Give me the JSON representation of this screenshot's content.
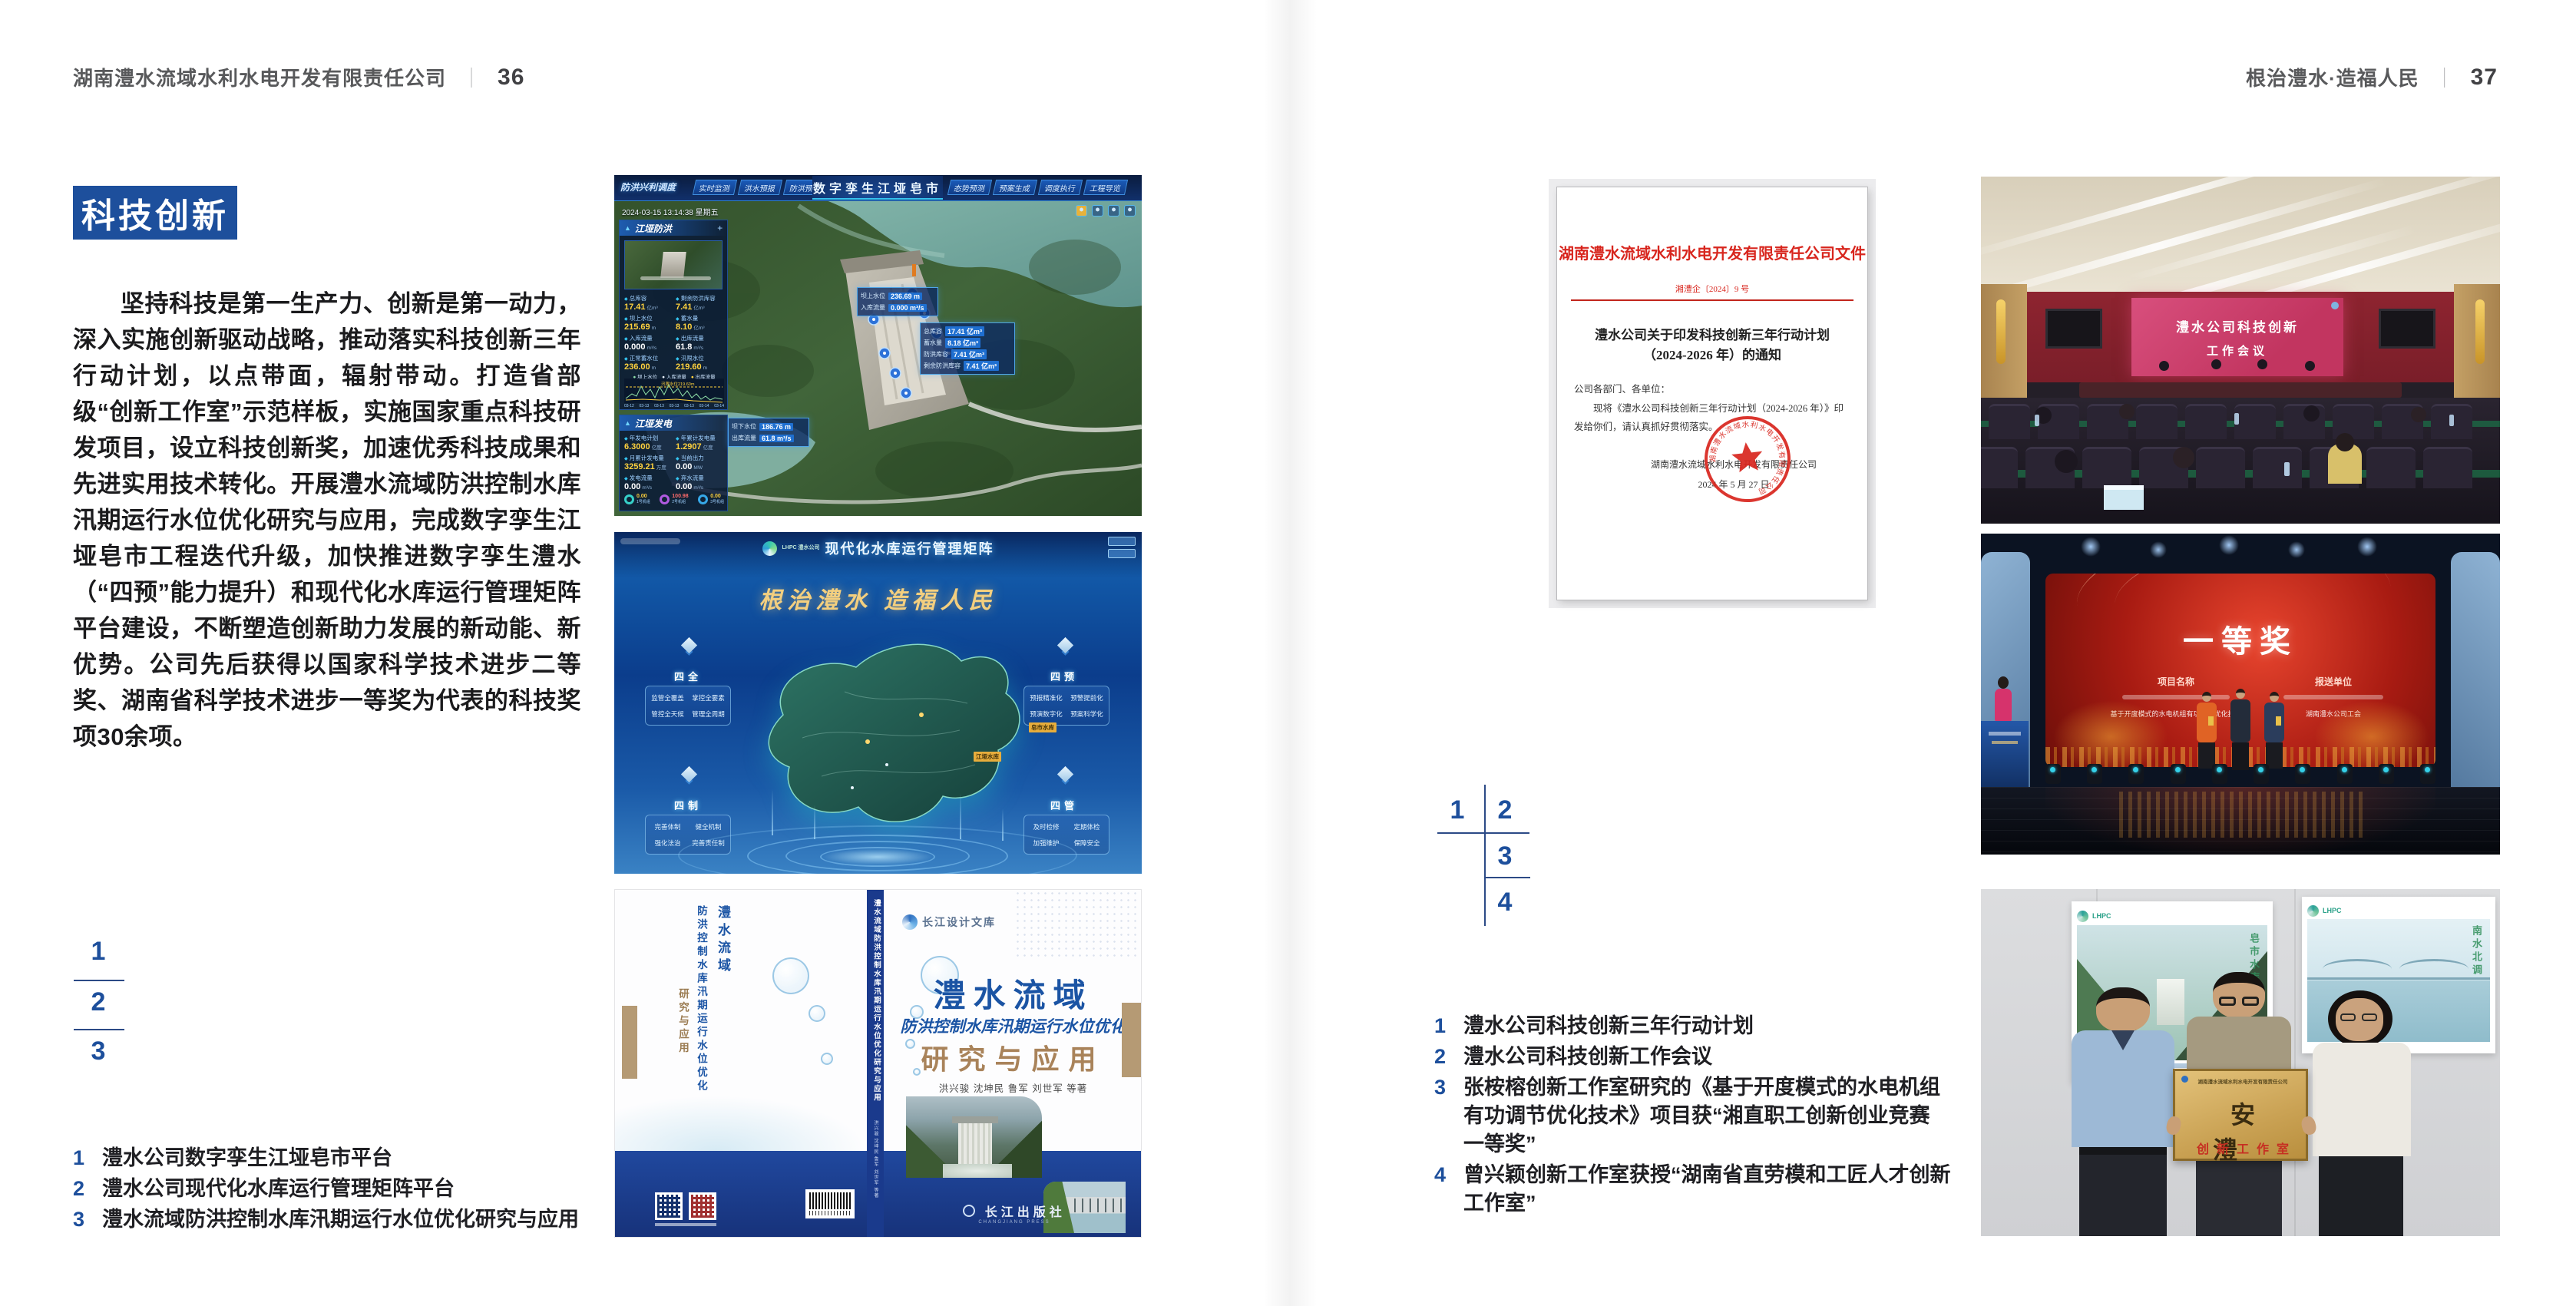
{
  "left_page": {
    "header": {
      "company": "湖南澧水流域水利水电开发有限责任公司",
      "divider": "｜",
      "page_no": "36"
    },
    "section_title": "科技创新",
    "body": "坚持科技是第一生产力、创新是第一动力，深入实施创新驱动战略，推动落实科技创新三年行动计划，以点带面，辐射带动。打造省部级“创新工作室”示范样板，实施国家重点科技研发项目，设立科技创新奖，加速优秀科技成果和先进实用技术转化。开展澧水流域防洪控制水库汛期运行水位优化研究与应用，完成数字孪生江垭皂市工程迭代升级，加快推进数字孪生澧水（“四预”能力提升）和现代化水库运行管理矩阵平台建设，不断塑造创新助力发展的新动能、新优势。公司先后获得以国家科学技术进步二等奖、湖南省科学技术进步一等奖为代表的科技奖项30余项。",
    "figure_markers": [
      "1",
      "2",
      "3"
    ],
    "captions": [
      {
        "no": "1",
        "text": "澧水公司数字孪生江垭皂市平台"
      },
      {
        "no": "2",
        "text": "澧水公司现代化水库运行管理矩阵平台"
      },
      {
        "no": "3",
        "text": "澧水流域防洪控制水库汛期运行水位优化研究与应用"
      }
    ]
  },
  "right_page": {
    "header": {
      "slogan": "根治澧水·造福人民",
      "divider": "｜",
      "page_no": "37"
    },
    "document": {
      "header": "湖南澧水流域水利水电开发有限责任公司文件",
      "doc_no": "湘澧企〔2024〕9 号",
      "title_line1": "澧水公司关于印发科技创新三年行动计划",
      "title_line2": "（2024-2026 年）的通知",
      "salutation": "公司各部门、各单位：",
      "body_line1": "现将《澧水公司科技创新三年行动计划（2024-2026 年）》印",
      "body_line2": "发给你们，请认真抓好贯彻落实。",
      "signer": "湖南澧水流域水利水电开发有限责任公司",
      "date": "2024 年 5 月 27 日"
    },
    "figure_markers": [
      "1",
      "2",
      "3",
      "4"
    ],
    "captions": [
      {
        "no": "1",
        "text": "澧水公司科技创新三年行动计划"
      },
      {
        "no": "2",
        "text": "澧水公司科技创新工作会议"
      },
      {
        "no": "3",
        "text": "张桉榕创新工作室研究的《基于开度模式的水电机组有功调节优化技术》项目获“湘直职工创新创业竞赛一等奖”"
      },
      {
        "no": "4",
        "text": "曾兴颖创新工作室获授“湖南省直劳模和工匠人才创新工作室”"
      }
    ]
  },
  "digital_twin": {
    "title": "数字孪生江垭皂市",
    "mode": "防洪兴利调度",
    "tabs_left": [
      "实时监测",
      "洪水预报",
      "防洪预警"
    ],
    "tabs_right": [
      "态势预测",
      "预案生成",
      "调度执行",
      "工程导览"
    ],
    "datetime": "2024-03-15 13:14:38 星期五",
    "panel_flood": {
      "title": "江垭防洪",
      "stats": [
        {
          "label": "总库容",
          "value": "17.41",
          "unit": "亿m³"
        },
        {
          "label": "剩余防洪库容",
          "value": "7.41",
          "unit": "亿m³"
        },
        {
          "label": "坝上水位",
          "value": "215.69",
          "unit": "m"
        },
        {
          "label": "蓄水量",
          "value": "8.10",
          "unit": "亿m³"
        },
        {
          "label": "入库流量",
          "value": "0.000",
          "unit": "m³/s"
        },
        {
          "label": "出库流量",
          "value": "61.8",
          "unit": "m³/s"
        },
        {
          "label": "正常蓄水位",
          "value": "236.00",
          "unit": "m"
        },
        {
          "label": "汛限水位",
          "value": "219.60",
          "unit": "m"
        }
      ],
      "legend": [
        "坝上水位",
        "入库流量",
        "出库流量"
      ],
      "annotation": "汛限水位219.60m",
      "x_ticks": [
        "03-12",
        "03-13",
        "03-13",
        "03-13",
        "03-13",
        "03-14",
        "03-14"
      ]
    },
    "panel_power": {
      "title": "江垭发电",
      "stats": [
        {
          "label": "年发电计划",
          "value": "6.3000",
          "unit": "亿度"
        },
        {
          "label": "年累计发电量",
          "value": "1.2907",
          "unit": "亿度"
        },
        {
          "label": "月累计发电量",
          "value": "3259.21",
          "unit": "万度"
        },
        {
          "label": "当前出力",
          "value": "0.00",
          "unit": "MW"
        },
        {
          "label": "发电流量",
          "value": "0.00",
          "unit": "m³/s"
        },
        {
          "label": "弃水流量",
          "value": "0.00",
          "unit": "m³/s"
        }
      ],
      "gauges": [
        {
          "value": "0.00",
          "label": "1号机组"
        },
        {
          "value": "100.98",
          "label": "2号机组"
        },
        {
          "value": "0.00",
          "label": "3号机组"
        }
      ]
    },
    "overlay_up": [
      {
        "label": "坝上水位",
        "value": "236.69 m"
      },
      {
        "label": "入库流量",
        "value": "0.000 m³/s"
      }
    ],
    "overlay_cap": [
      {
        "label": "总库容",
        "value": "17.41 亿m³"
      },
      {
        "label": "蓄水量",
        "value": "8.18 亿m³"
      },
      {
        "label": "防洪库容",
        "value": "7.41 亿m³"
      },
      {
        "label": "剩余防洪库容",
        "value": "7.41 亿m³"
      }
    ],
    "overlay_down": [
      {
        "label": "坝下水位",
        "value": "186.76 m"
      },
      {
        "label": "出库流量",
        "value": "61.8 m³/s"
      }
    ]
  },
  "matrix_platform": {
    "brand": "LHPC 澧水公司",
    "title": "现代化水库运行管理矩阵",
    "slogan": "根治澧水 造福人民",
    "groups": [
      {
        "name": "四全",
        "items": [
          "监管全覆盖",
          "掌控全要素",
          "管控全天候",
          "管理全周期"
        ]
      },
      {
        "name": "四预",
        "items": [
          "预报精准化",
          "预警提前化",
          "预演数字化",
          "预案科学化"
        ]
      },
      {
        "name": "四制",
        "items": [
          "完善体制",
          "健全机制",
          "强化法治",
          "完善责任制"
        ]
      },
      {
        "name": "四管",
        "items": [
          "及时检修",
          "定期体检",
          "加强维护",
          "保障安全"
        ]
      }
    ],
    "map_labels": [
      "皂市水库",
      "江垭水库"
    ]
  },
  "book": {
    "library": "长江设计文库",
    "title_main": "澧水流域",
    "title_sub": "防洪控制水库汛期运行水位优化",
    "title_tail": "研究与应用",
    "authors": "洪兴骏 沈坤民 鲁军 刘世军 等著",
    "publisher": "长江出版社",
    "publisher_en": "CHANGJIANG PRESS",
    "spine": "澧水流域防洪控制水库汛期运行水位优化研究与应用",
    "back_lines": [
      "澧水流域",
      "防洪控制水库汛期运行水位优化",
      "研究与应用"
    ]
  },
  "meeting": {
    "screen_line1": "澧水公司科技创新",
    "screen_line2": "工作会议"
  },
  "award": {
    "title": "一等奖",
    "col1": "项目名称",
    "col2": "报送单位",
    "project": "基于开度模式的水电机组有功调节优化技术",
    "unit": "湖南澧水公司工会"
  },
  "plaque": {
    "org": "湖南澧水流域水利水电开发有限责任公司",
    "name": "安澧",
    "sub": "创新工作室"
  },
  "colors": {
    "accent": "#1d4f9c",
    "doc_red": "#d8261e",
    "book_blue": "#1b54a4",
    "book_tan": "#a9835a"
  }
}
